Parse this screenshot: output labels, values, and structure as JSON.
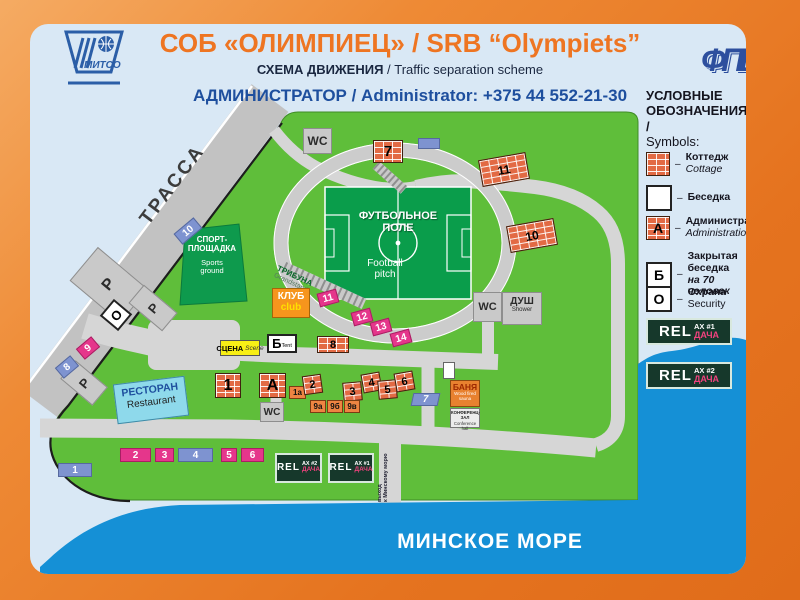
{
  "header": {
    "logo_mitso": "МИТСО",
    "logo_fpb": "ФПБ",
    "title": "СОБ «ОЛИМПИЕЦ» / SRB “Olympiets”",
    "scheme_ru": "СХЕМА ДВИЖЕНИЯ",
    "scheme_en": " / Traffic separation scheme",
    "admin": "АДМИНИСТРАТОР / Administrator: +375 44 552-21-30"
  },
  "legend": {
    "heading_line1": "УСЛОВНЫЕ",
    "heading_line2": "ОБОЗНАЧЕНИЯ /",
    "heading_line3": "Symbols:",
    "dash": "–",
    "items": [
      {
        "letter": "",
        "line1": "Коттедж",
        "line2": "Cottage"
      },
      {
        "letter": "",
        "line1": "Беседка",
        "line2": ""
      },
      {
        "letter": "А",
        "line1": "Администрация",
        "line2": "Administration"
      },
      {
        "letter": "Б",
        "line1": "Закрытая беседка",
        "line2": "на 70 человек"
      },
      {
        "letter": "О",
        "line1": "Охрана",
        "line2": "Security"
      }
    ],
    "relax_1": {
      "rel": "REL",
      "ax": "AX #1",
      "dacha": "ДАЧА"
    },
    "relax_2": {
      "rel": "REL",
      "ax": "AX #2",
      "dacha": "ДАЧА"
    }
  },
  "map": {
    "highway": "ТРАССА",
    "sea": "МИНСКОЕ МОРЕ",
    "exit_line1": "выход",
    "exit_line2": "к Минскому морю",
    "parking": "Р",
    "security": "О",
    "wc": "WC",
    "shower_ru": "ДУШ",
    "shower_en": "Shower",
    "sports_ru1": "СПОРТ-",
    "sports_ru2": "ПЛОЩАДКА",
    "sports_en1": "Sports",
    "sports_en2": "ground",
    "field_ru1": "ФУТБОЛЬНОЕ",
    "field_ru2": "ПОЛЕ",
    "field_en1": "Football",
    "field_en2": "pitch",
    "grandstand_ru": "ТРИБУНА",
    "grandstand_en": "Grandstand",
    "club_ru": "КЛУБ",
    "club_en": "club",
    "stage_ru": "СЦЕНА",
    "stage_en": "Scene",
    "tent_letter": "Б",
    "tent_en": "Tent",
    "restaurant_ru": "РЕСТОРАН",
    "restaurant_en": "Restaurant",
    "sauna_ru": "БАНЯ",
    "sauna_en1": "Wood fired",
    "sauna_en2": "sauna",
    "conf_ru": "КОНФЕРЕНЦ-ЗАЛ",
    "conf_en": "Conference hall",
    "buildings": {
      "b7": "7",
      "b11": "11",
      "b10": "10",
      "b8": "8",
      "b1": "1",
      "bA": "А",
      "b1a": "1а",
      "b2": "2",
      "b3": "3",
      "b4": "4",
      "b5": "5",
      "b6": "6",
      "b9a": "9а",
      "b9b": "9б",
      "b9v": "9в"
    },
    "badges": {
      "n8": "8",
      "n9": "9",
      "n10": "10",
      "n11": "11",
      "n12": "12",
      "n13": "13",
      "n14": "14",
      "s1": "1",
      "s2": "2",
      "s3": "3",
      "s4": "4",
      "s5": "5",
      "s6": "6",
      "e7": "7"
    },
    "relax_left": {
      "rel": "REL",
      "ax": "AX #2",
      "dacha": "ДАЧА"
    },
    "relax_right": {
      "rel": "REL",
      "ax": "AX #1",
      "dacha": "ДАЧА"
    }
  }
}
